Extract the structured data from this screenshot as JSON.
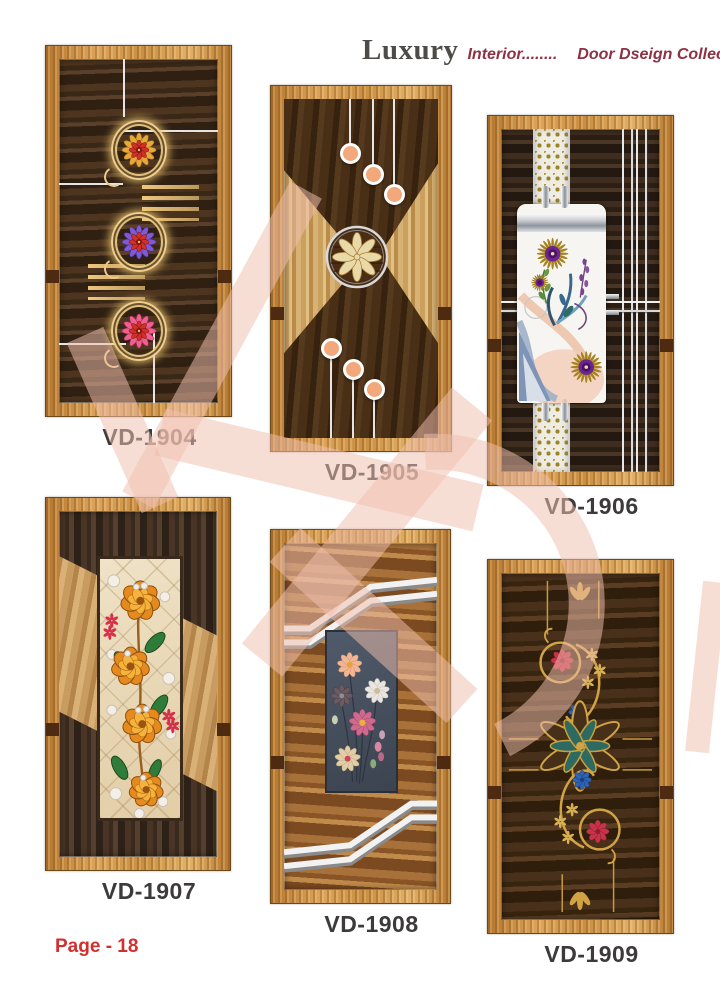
{
  "header": {
    "brand": "Luxury",
    "tagline": "Interior........",
    "collection": "Door Dseign Collecation...."
  },
  "doors": [
    {
      "code": "VD-1904"
    },
    {
      "code": "VD-1905"
    },
    {
      "code": "VD-1906"
    },
    {
      "code": "VD-1907"
    },
    {
      "code": "VD-1908"
    },
    {
      "code": "VD-1909"
    }
  ],
  "footer": {
    "page_label": "Page - 18"
  },
  "colors": {
    "frame_wood": "#cf9348",
    "dark_wood": "#3a2817",
    "label_text": "#3c3a3b",
    "header_accent": "#8d3243",
    "page_number": "#d32f2f",
    "watermark_pink": "#f0c0ae",
    "gold_inlay": "#d2a344"
  }
}
